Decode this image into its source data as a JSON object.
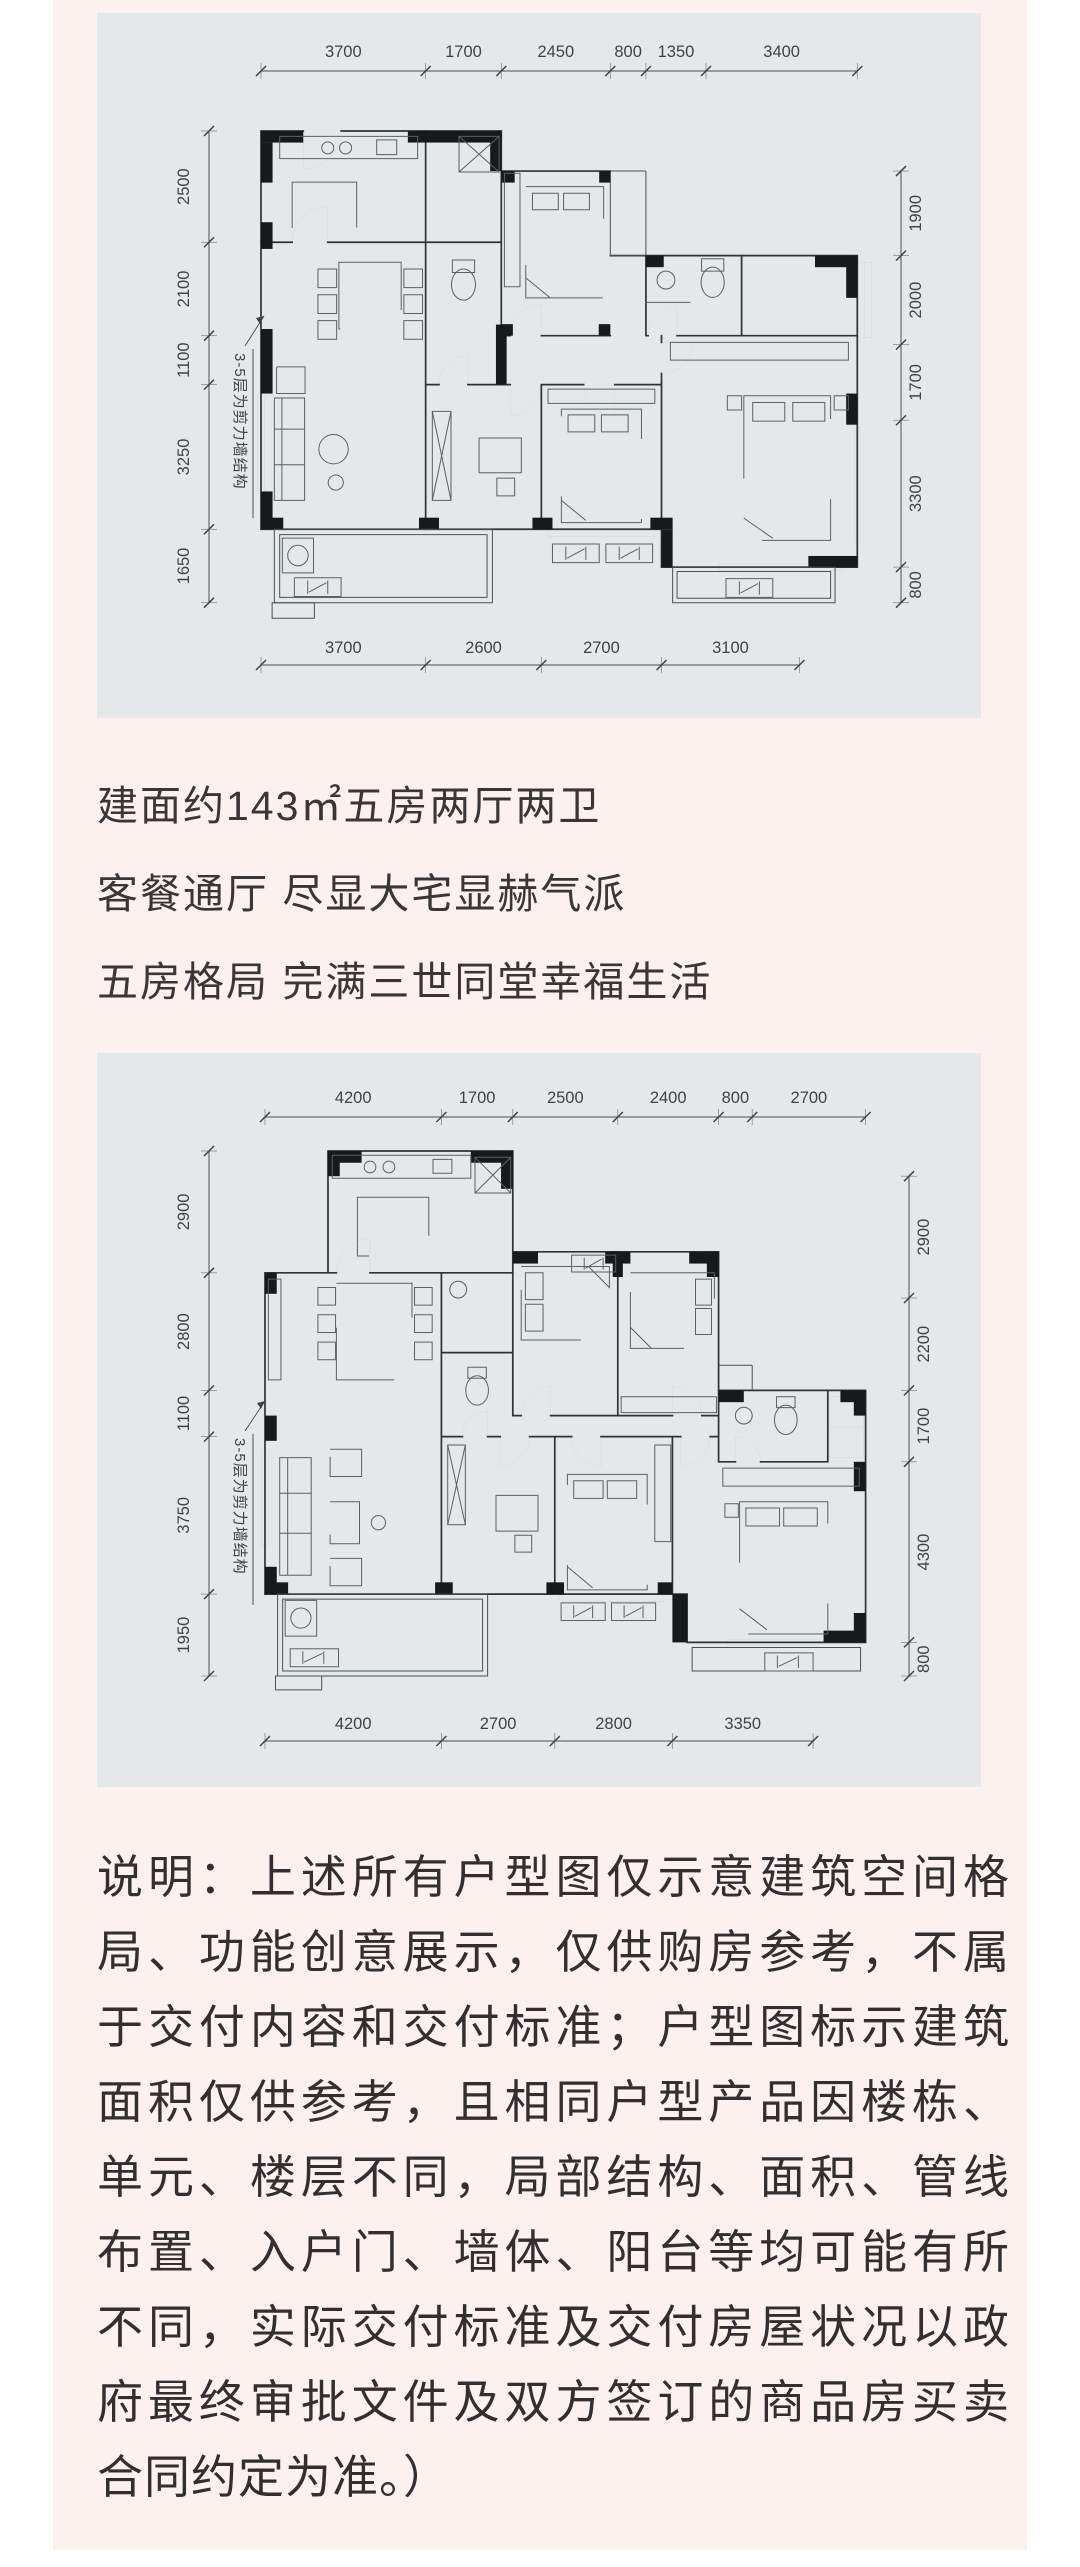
{
  "colors": {
    "page_bg": "#ffffff",
    "content_bg": "#fdf1ef",
    "panel_bg": "#e4e8e9",
    "wall_black": "#17191c",
    "line_gray": "#4a4f54",
    "text_dark": "#3a3536"
  },
  "headline": {
    "lines": [
      "建面约143㎡五房两厅两卫",
      "客餐通厅 尽显大宅显赫气派",
      "五房格局 完满三世同堂幸福生活"
    ]
  },
  "plans": [
    {
      "structure_note": "3-5层为剪力墙结构",
      "dims": {
        "top": [
          3700,
          1700,
          2450,
          800,
          1350,
          3400
        ],
        "bottom": [
          3700,
          2600,
          2700,
          3100
        ],
        "left": [
          2500,
          2100,
          1100,
          3250,
          1650
        ],
        "right": [
          1900,
          2000,
          1700,
          3300,
          800
        ]
      }
    },
    {
      "structure_note": "3-5层为剪力墙结构",
      "dims": {
        "top": [
          4200,
          1700,
          2500,
          2400,
          800,
          2700
        ],
        "bottom": [
          4200,
          2700,
          2800,
          3350
        ],
        "left": [
          2900,
          2800,
          1100,
          3750,
          1950
        ],
        "right": [
          2900,
          2200,
          1700,
          4300,
          800
        ]
      }
    }
  ],
  "disclaimer": {
    "lines": [
      "说明：上述所有户型图仅示意建筑空间格",
      "局、功能创意展示，仅供购房参考，不属",
      "于交付内容和交付标准；户型图标示建筑",
      "面积仅供参考，且相同户型产品因楼栋、",
      "单元、楼层不同，局部结构、面积、管线",
      "布置、入户门、墙体、阳台等均可能有所",
      "不同，实际交付标准及交付房屋状况以政",
      "府最终审批文件及双方签订的商品房买卖",
      "合同约定为准。）"
    ]
  }
}
